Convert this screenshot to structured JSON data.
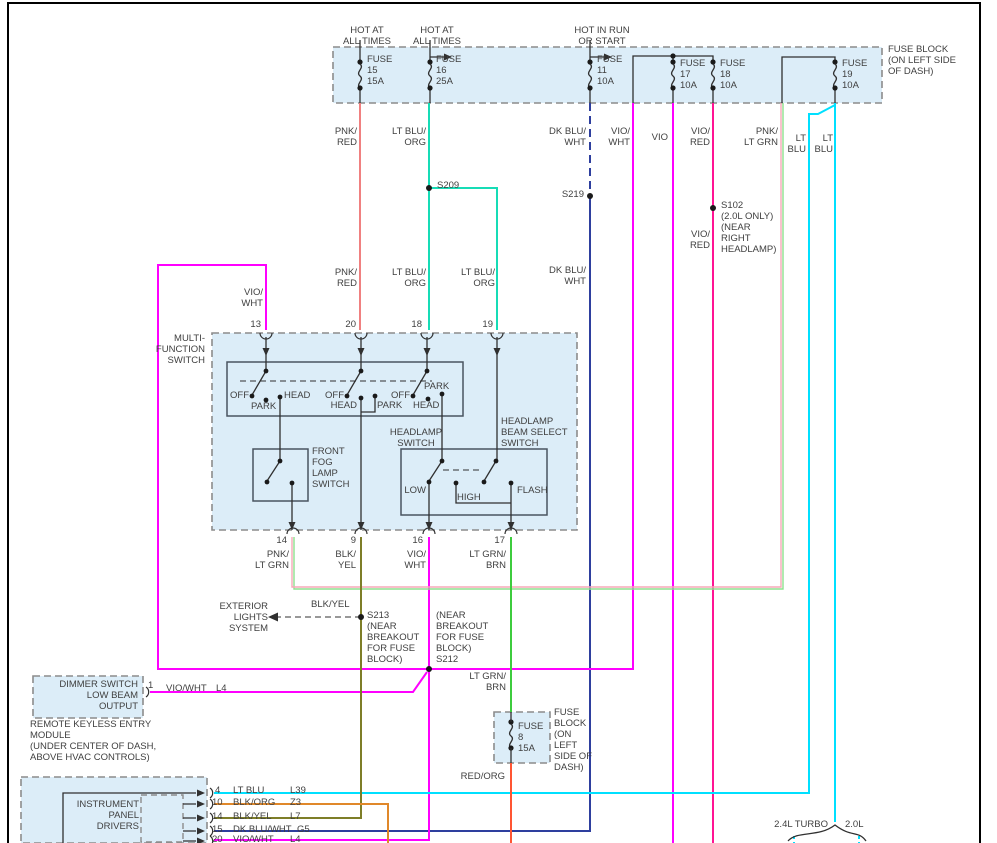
{
  "diagram_title": "Headlamp / Multi-Function Switch Wiring Diagram",
  "colors": {
    "pnk_red": "#F08080",
    "lt_blu_org": "#16DCB6",
    "dk_blu_wht": "#2E3F9E",
    "vio_wht": "#FF00FF",
    "vio": "#FF00FF",
    "vio_red": "#FF1493",
    "pnk_lt_grn_pink": "#F7A8B8",
    "pnk_lt_grn_grn": "#8FE08F",
    "lt_blu": "#00E0FF",
    "lt_grn_brn": "#3DCC3D",
    "blk_yel": "#7E7E28",
    "blk_org": "#E0882A",
    "red_org": "#FF5533",
    "diagram_line": "#303030"
  },
  "labels": [
    {
      "name": "hot-at-all-times-1",
      "text": "HOT AT\nALL TIMES",
      "cx": 367,
      "y": 25,
      "align": "c"
    },
    {
      "name": "hot-at-all-times-2",
      "text": "HOT AT\nALL TIMES",
      "cx": 437,
      "y": 25,
      "align": "c"
    },
    {
      "name": "hot-in-run-or-start",
      "text": "HOT IN RUN\nOR START",
      "cx": 602,
      "y": 25,
      "align": "c"
    },
    {
      "name": "fuse-block-title",
      "text": "FUSE BLOCK\n(ON LEFT SIDE\nOF DASH)",
      "x": 888,
      "y": 44,
      "align": "l"
    },
    {
      "name": "fuse-15-label",
      "text": "FUSE\n15\n15A",
      "x": 367,
      "y": 54,
      "align": "l"
    },
    {
      "name": "fuse-16-label",
      "text": "FUSE\n16\n25A",
      "x": 436,
      "y": 54,
      "align": "l"
    },
    {
      "name": "fuse-11-label",
      "text": "FUSE\n11\n10A",
      "x": 597,
      "y": 54,
      "align": "l"
    },
    {
      "name": "fuse-17-label",
      "text": "FUSE\n17\n10A",
      "x": 680,
      "y": 58,
      "align": "l"
    },
    {
      "name": "fuse-18-label",
      "text": "FUSE\n18\n10A",
      "x": 720,
      "y": 58,
      "align": "l"
    },
    {
      "name": "fuse-19-label",
      "text": "FUSE\n19\n10A",
      "x": 842,
      "y": 58,
      "align": "l"
    },
    {
      "name": "wire-pnk-red-label-1",
      "text": "PNK/\nRED",
      "r": 357,
      "y": 126,
      "align": "r"
    },
    {
      "name": "wire-lt-blu-org-label-1",
      "text": "LT BLU/\nORG",
      "r": 426,
      "y": 126,
      "align": "r"
    },
    {
      "name": "wire-dk-blu-wht-label-1",
      "text": "DK BLU/\nWHT",
      "r": 586,
      "y": 126,
      "align": "r"
    },
    {
      "name": "wire-vio-wht-label-1",
      "text": "VIO/\nWHT",
      "r": 630,
      "y": 126,
      "align": "r"
    },
    {
      "name": "wire-vio-label",
      "text": "VIO",
      "r": 668,
      "y": 132,
      "align": "r"
    },
    {
      "name": "wire-vio-red-label-1",
      "text": "VIO/\nRED",
      "r": 710,
      "y": 126,
      "align": "r"
    },
    {
      "name": "wire-pnk-lt-grn-label-1",
      "text": "PNK/\nLT GRN",
      "r": 778,
      "y": 126,
      "align": "r"
    },
    {
      "name": "wire-lt-blu-label-1",
      "text": "LT\nBLU",
      "r": 806,
      "y": 133,
      "align": "r"
    },
    {
      "name": "wire-lt-blu-label-2",
      "text": "LT\nBLU",
      "r": 833,
      "y": 133,
      "align": "r"
    },
    {
      "name": "splice-s209-label",
      "text": "S209",
      "x": 437,
      "y": 180,
      "align": "l"
    },
    {
      "name": "splice-s219-label",
      "text": "S219",
      "r": 584,
      "y": 189,
      "align": "r"
    },
    {
      "name": "splice-s102-label",
      "text": "S102\n(2.0L ONLY)\n(NEAR\nRIGHT\nHEADLAMP)",
      "x": 721,
      "y": 200,
      "align": "l"
    },
    {
      "name": "wire-vio-red-label-2",
      "text": "VIO/\nRED",
      "r": 710,
      "y": 229,
      "align": "r"
    },
    {
      "name": "wire-pnk-red-label-2",
      "text": "PNK/\nRED",
      "r": 357,
      "y": 267,
      "align": "r"
    },
    {
      "name": "wire-lt-blu-org-label-2",
      "text": "LT BLU/\nORG",
      "r": 426,
      "y": 267,
      "align": "r"
    },
    {
      "name": "wire-lt-blu-org-label-3",
      "text": "LT BLU/\nORG",
      "r": 495,
      "y": 267,
      "align": "r"
    },
    {
      "name": "wire-dk-blu-wht-label-2",
      "text": "DK BLU/\nWHT",
      "r": 586,
      "y": 265,
      "align": "r"
    },
    {
      "name": "wire-vio-wht-label-2",
      "text": "VIO/\nWHT",
      "r": 263,
      "y": 287,
      "align": "r"
    },
    {
      "name": "pin-13-label",
      "text": "13",
      "r": 261,
      "y": 319,
      "align": "r"
    },
    {
      "name": "pin-20-label",
      "text": "20",
      "r": 356,
      "y": 319,
      "align": "r"
    },
    {
      "name": "pin-18-label",
      "text": "18",
      "r": 422,
      "y": 319,
      "align": "r"
    },
    {
      "name": "pin-19-label",
      "text": "19",
      "r": 493,
      "y": 319,
      "align": "r"
    },
    {
      "name": "multi-function-switch-title",
      "text": "MULTI-\nFUNCTION\nSWITCH",
      "r": 205,
      "y": 333,
      "align": "r"
    },
    {
      "name": "pole1-off-label",
      "text": "OFF",
      "r": 249,
      "y": 390,
      "align": "r"
    },
    {
      "name": "pole1-park-label",
      "text": "PARK",
      "x": 251,
      "y": 401,
      "align": "l"
    },
    {
      "name": "pole1-head-label",
      "text": "HEAD",
      "x": 284,
      "y": 390,
      "align": "l"
    },
    {
      "name": "pole2-off-label",
      "text": "OFF",
      "r": 344,
      "y": 390,
      "align": "r"
    },
    {
      "name": "pole2-head-label",
      "text": "HEAD",
      "r": 357,
      "y": 400,
      "align": "r"
    },
    {
      "name": "pole2-park-label",
      "text": "PARK",
      "x": 377,
      "y": 400,
      "align": "l"
    },
    {
      "name": "pole3-off-label",
      "text": "OFF",
      "r": 410,
      "y": 390,
      "align": "r"
    },
    {
      "name": "pole3-park-label",
      "text": "PARK",
      "x": 424,
      "y": 381,
      "align": "l"
    },
    {
      "name": "pole3-head-label",
      "text": "HEAD",
      "x": 413,
      "y": 400,
      "align": "l"
    },
    {
      "name": "headlamp-switch-title",
      "text": "HEADLAMP\nSWITCH",
      "cx": 416,
      "y": 427,
      "align": "c"
    },
    {
      "name": "beam-select-switch-title",
      "text": "HEADLAMP\nBEAM SELECT\nSWITCH",
      "x": 501,
      "y": 416,
      "align": "l"
    },
    {
      "name": "front-fog-lamp-switch-title",
      "text": "FRONT\nFOG\nLAMP\nSWITCH",
      "x": 312,
      "y": 446,
      "align": "l"
    },
    {
      "name": "beam-low-label",
      "text": "LOW",
      "r": 426,
      "y": 485,
      "align": "r"
    },
    {
      "name": "beam-high-label",
      "text": "HIGH",
      "x": 457,
      "y": 492,
      "align": "l"
    },
    {
      "name": "beam-flash-label",
      "text": "FLASH",
      "x": 517,
      "y": 485,
      "align": "l"
    },
    {
      "name": "pin-14-label",
      "text": "14",
      "r": 287,
      "y": 535,
      "align": "r"
    },
    {
      "name": "pin-9-label",
      "text": "9",
      "r": 356,
      "y": 535,
      "align": "r"
    },
    {
      "name": "pin-16-label",
      "text": "16",
      "r": 423,
      "y": 535,
      "align": "r"
    },
    {
      "name": "pin-17-label",
      "text": "17",
      "r": 505,
      "y": 535,
      "align": "r"
    },
    {
      "name": "wire-pnk-lt-grn-label-2",
      "text": "PNK/\nLT GRN",
      "r": 289,
      "y": 549,
      "align": "r"
    },
    {
      "name": "wire-blk-yel-label-1",
      "text": "BLK/\nYEL",
      "r": 356,
      "y": 549,
      "align": "r"
    },
    {
      "name": "wire-vio-wht-label-3",
      "text": "VIO/\nWHT",
      "r": 426,
      "y": 549,
      "align": "r"
    },
    {
      "name": "wire-lt-grn-brn-label-1",
      "text": "LT GRN/\nBRN",
      "r": 506,
      "y": 549,
      "align": "r"
    },
    {
      "name": "exterior-lights-system-label",
      "text": "EXTERIOR\nLIGHTS\nSYSTEM",
      "r": 268,
      "y": 601,
      "align": "r"
    },
    {
      "name": "wire-blk-yel-label-2",
      "text": "BLK/YEL",
      "x": 311,
      "y": 599,
      "align": "l"
    },
    {
      "name": "splice-s213-label",
      "text": "S213\n(NEAR\nBREAKOUT\nFOR FUSE\nBLOCK)",
      "x": 367,
      "y": 610,
      "align": "l"
    },
    {
      "name": "splice-s212-label",
      "text": "(NEAR\nBREAKOUT\nFOR FUSE\nBLOCK)\nS212",
      "x": 436,
      "y": 610,
      "align": "l"
    },
    {
      "name": "wire-lt-grn-brn-label-2",
      "text": "LT GRN/\nBRN",
      "r": 506,
      "y": 671,
      "align": "r"
    },
    {
      "name": "dimmer-switch-title",
      "text": "DIMMER SWITCH\nLOW BEAM\nOUTPUT",
      "r": 138,
      "y": 679,
      "align": "r"
    },
    {
      "name": "dimmer-pin-1-label",
      "text": "1",
      "x": 148,
      "y": 680,
      "align": "l"
    },
    {
      "name": "wire-vio-wht-label-4",
      "text": "VIO/WHT",
      "x": 166,
      "y": 683,
      "align": "l"
    },
    {
      "name": "circuit-l4-label-1",
      "text": "L4",
      "x": 216,
      "y": 683,
      "align": "l"
    },
    {
      "name": "remote-keyless-entry-label",
      "text": "REMOTE KEYLESS ENTRY\nMODULE\n(UNDER CENTER OF DASH,\nABOVE HVAC CONTROLS)",
      "x": 30,
      "y": 719,
      "align": "l"
    },
    {
      "name": "fuse-8-label",
      "text": "FUSE\n8\n15A",
      "x": 518,
      "y": 721,
      "align": "l"
    },
    {
      "name": "fuse-8-block-label",
      "text": "FUSE\nBLOCK\n(ON\nLEFT\nSIDE OF\nDASH)",
      "x": 554,
      "y": 707,
      "align": "l"
    },
    {
      "name": "wire-red-org-label",
      "text": "RED/ORG",
      "r": 505,
      "y": 771,
      "align": "r"
    },
    {
      "name": "instrument-panel-drivers-title",
      "text": "INSTRUMENT\nPANEL\nDRIVERS",
      "r": 139,
      "y": 799,
      "align": "r"
    },
    {
      "name": "ip-pin-4-label",
      "text": "4",
      "x": 215,
      "y": 785,
      "align": "l"
    },
    {
      "name": "ip-wire-lt-blu-label",
      "text": "LT BLU",
      "x": 233,
      "y": 785,
      "align": "l"
    },
    {
      "name": "circuit-l39-label",
      "text": "L39",
      "x": 290,
      "y": 785,
      "align": "l"
    },
    {
      "name": "ip-pin-10-label",
      "text": "10",
      "x": 212,
      "y": 797,
      "align": "l"
    },
    {
      "name": "ip-wire-blk-org-label",
      "text": "BLK/ORG",
      "x": 233,
      "y": 797,
      "align": "l"
    },
    {
      "name": "circuit-z3-label",
      "text": "Z3",
      "x": 290,
      "y": 797,
      "align": "l"
    },
    {
      "name": "ip-pin-14-label",
      "text": "14",
      "x": 212,
      "y": 811,
      "align": "l"
    },
    {
      "name": "ip-wire-blk-yel-label",
      "text": "BLK/YEL",
      "x": 233,
      "y": 811,
      "align": "l"
    },
    {
      "name": "circuit-l7-label",
      "text": "L7",
      "x": 290,
      "y": 811,
      "align": "l"
    },
    {
      "name": "ip-pin-15-label",
      "text": "15",
      "x": 212,
      "y": 824,
      "align": "l"
    },
    {
      "name": "ip-wire-dk-blu-wht-label",
      "text": "DK BLU/WHT",
      "x": 233,
      "y": 824,
      "align": "l"
    },
    {
      "name": "circuit-g5-label",
      "text": "G5",
      "x": 297,
      "y": 824,
      "align": "l"
    },
    {
      "name": "ip-pin-20-label",
      "text": "20",
      "x": 212,
      "y": 834,
      "align": "l"
    },
    {
      "name": "ip-wire-vio-wht-label",
      "text": "VIO/WHT",
      "x": 233,
      "y": 834,
      "align": "l"
    },
    {
      "name": "circuit-l4-label-2",
      "text": "L4",
      "x": 290,
      "y": 834,
      "align": "l"
    },
    {
      "name": "engine-24l-turbo-label",
      "text": "2.4L TURBO",
      "r": 828,
      "y": 819,
      "align": "r"
    },
    {
      "name": "engine-20l-label",
      "text": "2.0L",
      "x": 845,
      "y": 819,
      "align": "l"
    }
  ]
}
